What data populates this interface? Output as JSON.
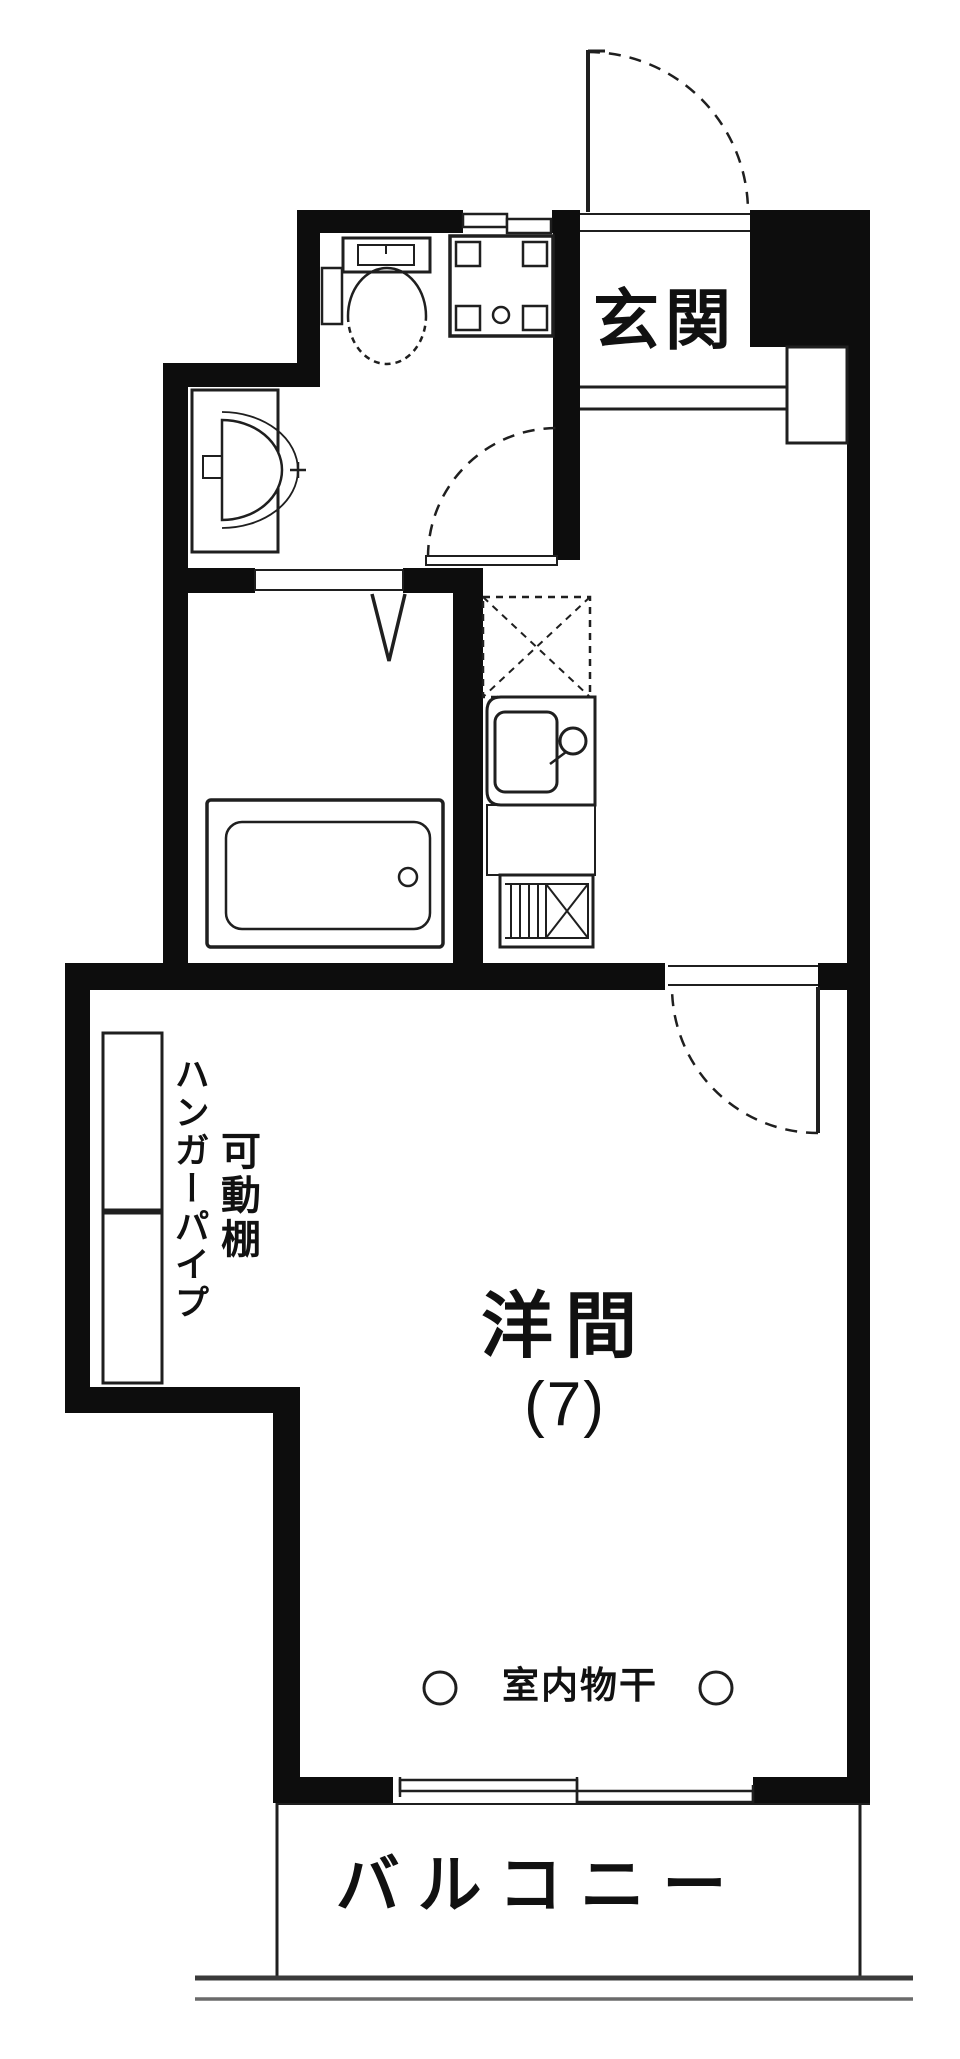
{
  "colors": {
    "wall": "#0d0d0d",
    "line": "#1f1f1f",
    "background": "#ffffff",
    "text": "#111111"
  },
  "labels": {
    "entrance": "玄関",
    "room": "洋間",
    "room_size": "(7)",
    "indoor_drying": "室内物干",
    "balcony": "バルコニー",
    "hanger_pipe": "ハンガーパイプ",
    "movable_shelf": "可動棚"
  },
  "fixtures": [
    "entrance-door",
    "small-window",
    "toilet",
    "washing-machine-pan",
    "wash-basin",
    "bathroom-folding-door",
    "bathtub",
    "washroom-door",
    "refrigerator-space",
    "kitchen-sink",
    "kitchen-counter",
    "gas-stove",
    "shoe-cabinet",
    "genkan-step",
    "room-door",
    "closet-shelves",
    "indoor-drying-hooks",
    "balcony-sliding-window",
    "balcony-rail",
    "building-base-lines"
  ]
}
